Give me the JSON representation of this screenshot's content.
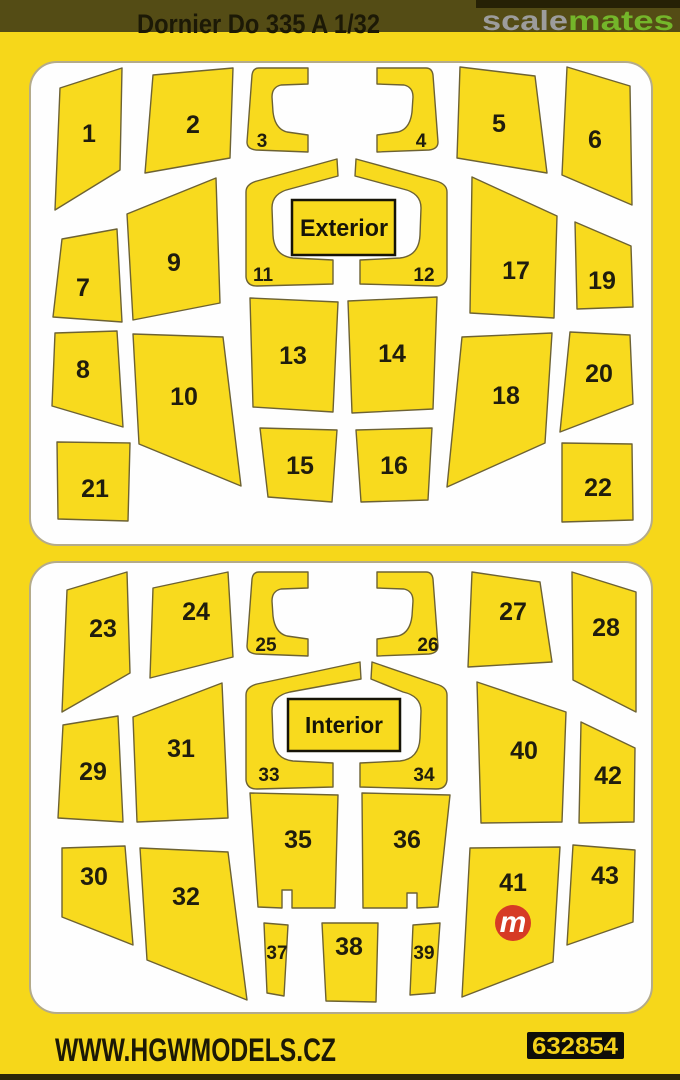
{
  "header": {
    "title": "Dornier Do 335 A 1/32",
    "watermark": {
      "scale": "scale",
      "mates": "mates"
    }
  },
  "panels": [
    {
      "label": "Exterior",
      "pieces": [
        "1",
        "2",
        "3",
        "4",
        "5",
        "6",
        "7",
        "8",
        "9",
        "10",
        "11",
        "12",
        "13",
        "14",
        "15",
        "16",
        "17",
        "18",
        "19",
        "20",
        "21",
        "22"
      ]
    },
    {
      "label": "Interior",
      "pieces": [
        "23",
        "24",
        "25",
        "26",
        "27",
        "28",
        "29",
        "30",
        "31",
        "32",
        "33",
        "34",
        "35",
        "36",
        "37",
        "38",
        "39",
        "40",
        "41",
        "42",
        "43"
      ]
    }
  ],
  "logo": {
    "letter": "m"
  },
  "footer": {
    "website": "WWW.HGWMODELS.CZ",
    "product_code": "632854"
  },
  "colors": {
    "background_yellow": "#f6d71a",
    "piece_yellow": "#f8da1e",
    "piece_outline": "#6d6233",
    "header_bar_olive": "#544c15",
    "watermark_gray": "#9c9c9c",
    "watermark_green": "#74b62a",
    "logo_red": "#d63b25",
    "panel_white": "#fefefe",
    "text_black": "#1c1906",
    "code_box_black": "#0f0e08"
  }
}
